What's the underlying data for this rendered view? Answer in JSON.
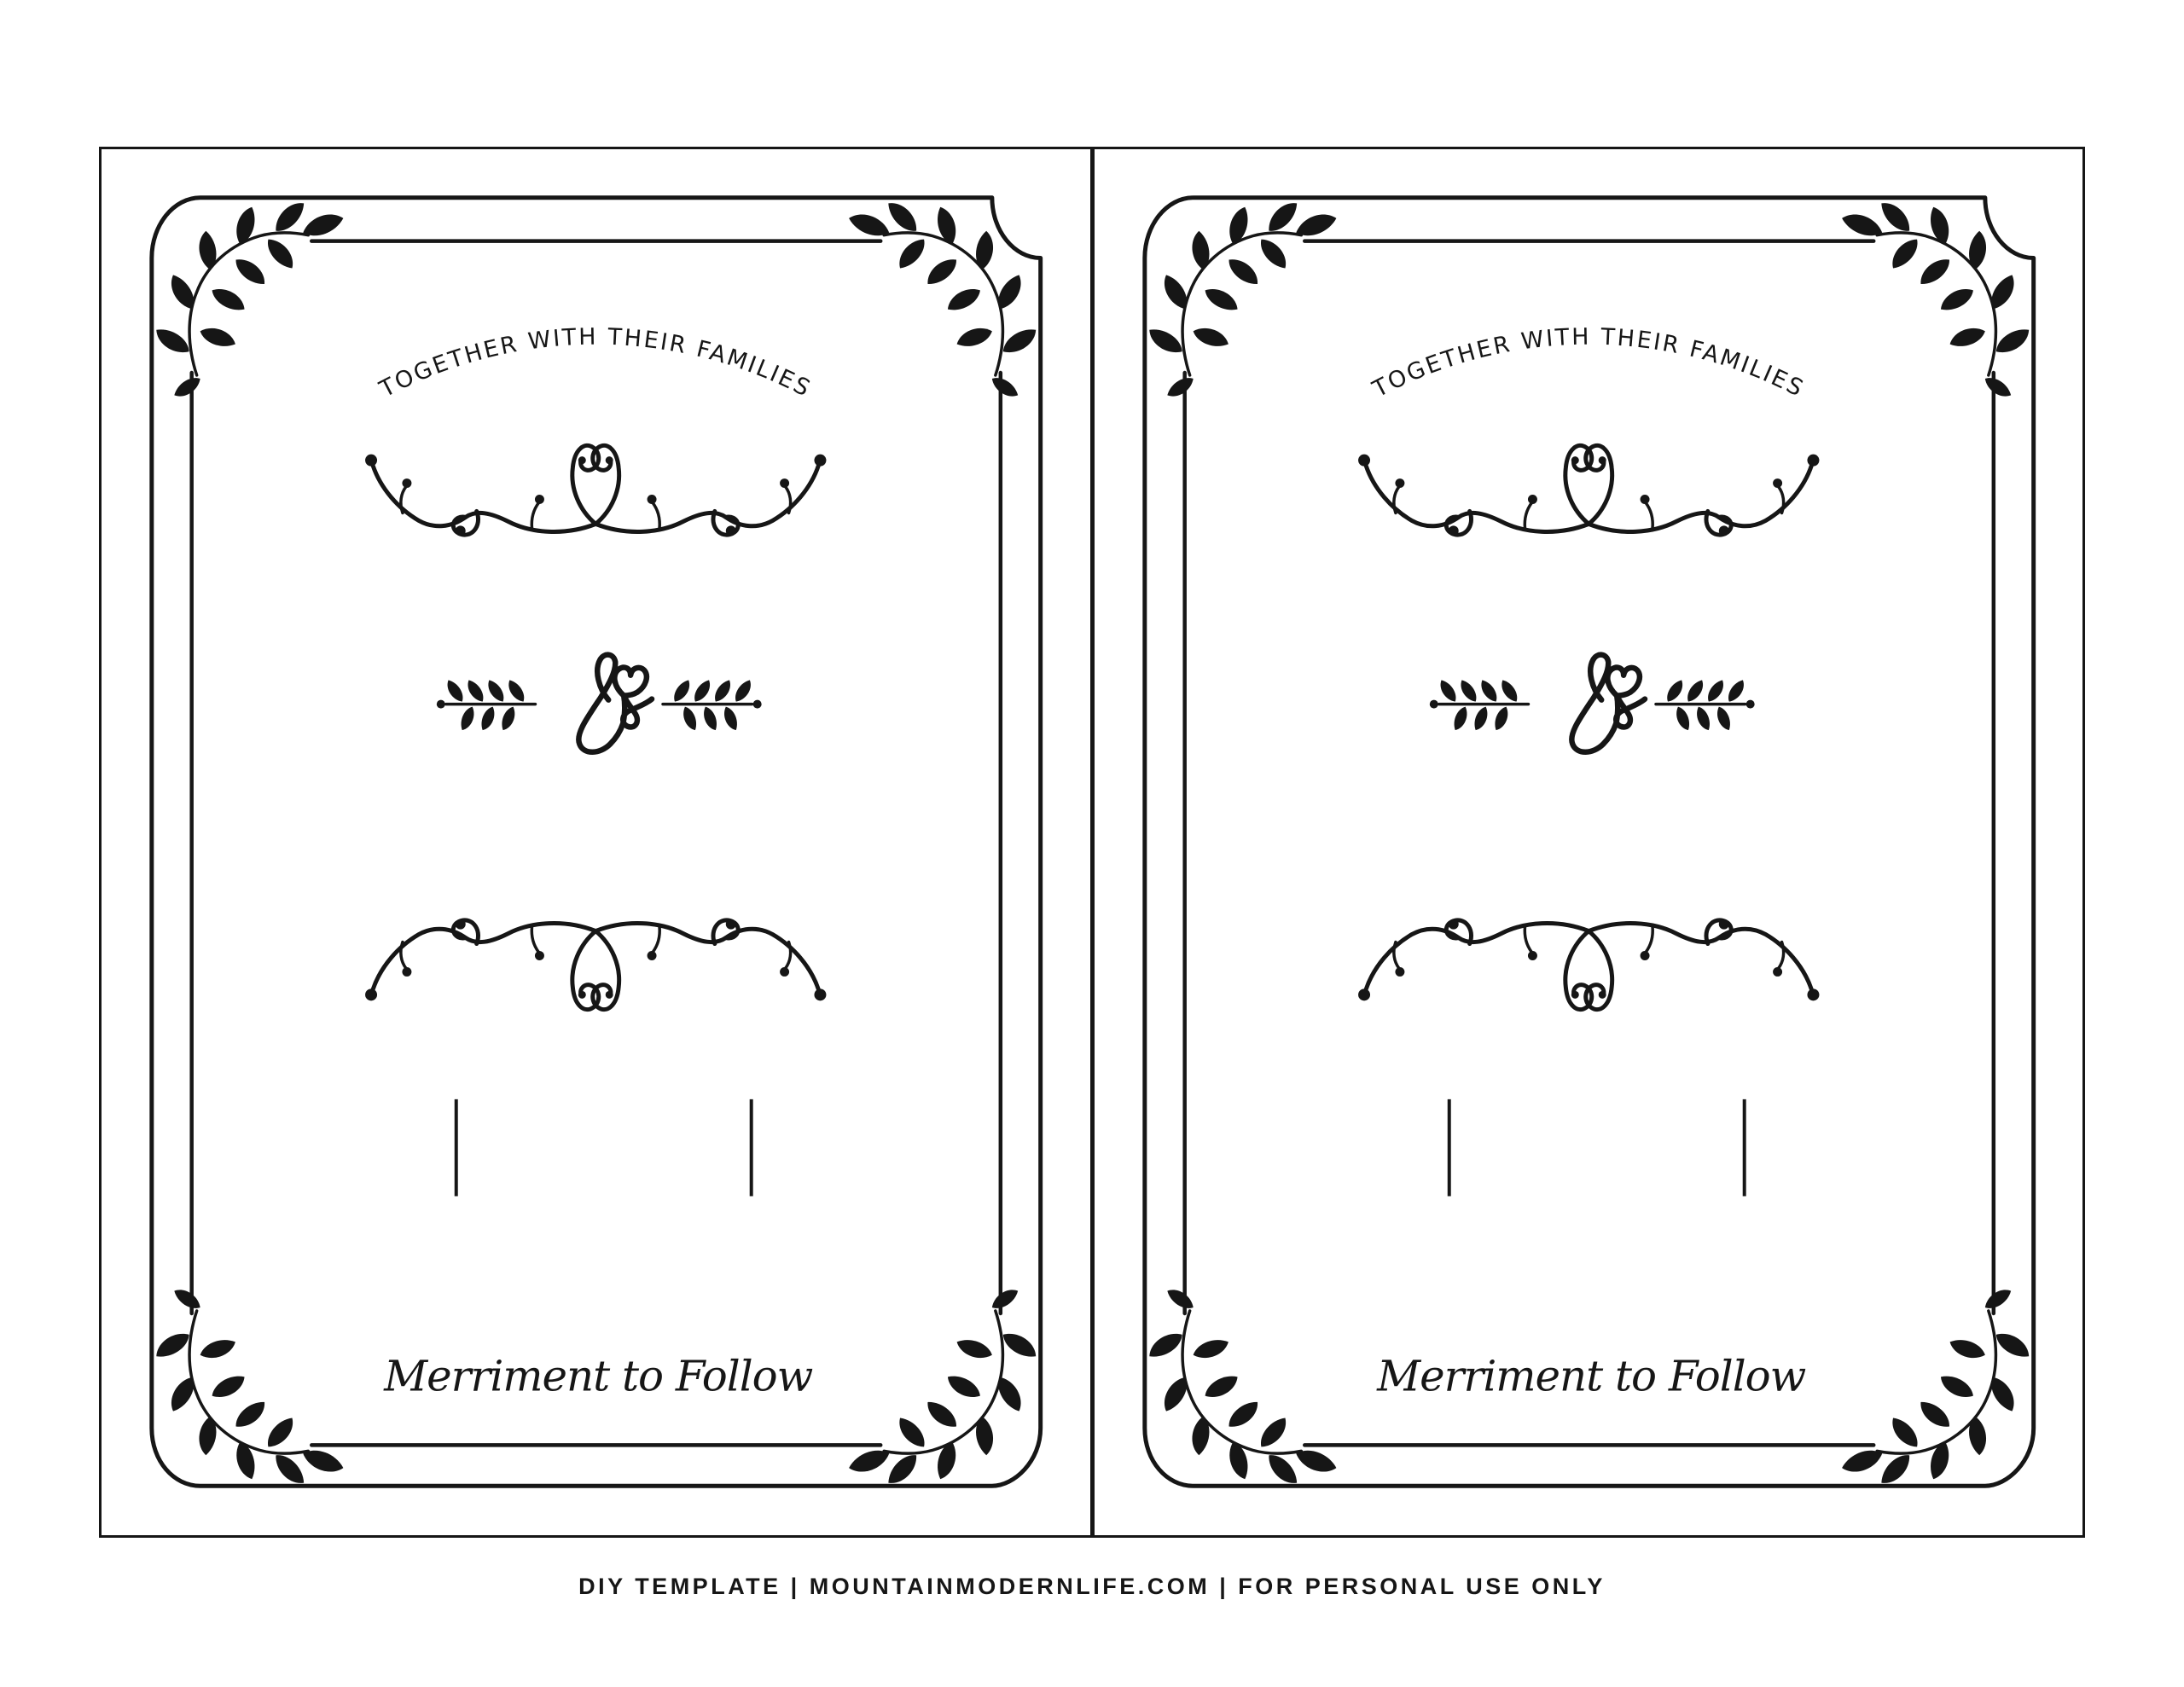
{
  "page": {
    "background": "#ffffff",
    "ink": "#161616",
    "description": "DIY wedding invitation printable template, two identical blank cards side by side"
  },
  "cards": [
    {
      "arc_text": "TOGETHER WITH THEIR FAMILIES",
      "bottom_text": "Merriment to Follow",
      "write_in_lines": 2,
      "ornament_icons": {
        "corners": "leaf-branch-icon",
        "divider_top": "vine-flourish-icon",
        "divider_bottom": "vine-flourish-icon",
        "center": "ampersand-heart-icon",
        "center_sides": "leaf-sprig-icon"
      }
    },
    {
      "arc_text": "TOGETHER WITH THEIR FAMILIES",
      "bottom_text": "Merriment to Follow",
      "write_in_lines": 2,
      "ornament_icons": {
        "corners": "leaf-branch-icon",
        "divider_top": "vine-flourish-icon",
        "divider_bottom": "vine-flourish-icon",
        "center": "ampersand-heart-icon",
        "center_sides": "leaf-sprig-icon"
      }
    }
  ],
  "footer": {
    "text": "DIY TEMPLATE | MOUNTAINMODERNLIFE.COM | FOR PERSONAL USE ONLY"
  }
}
